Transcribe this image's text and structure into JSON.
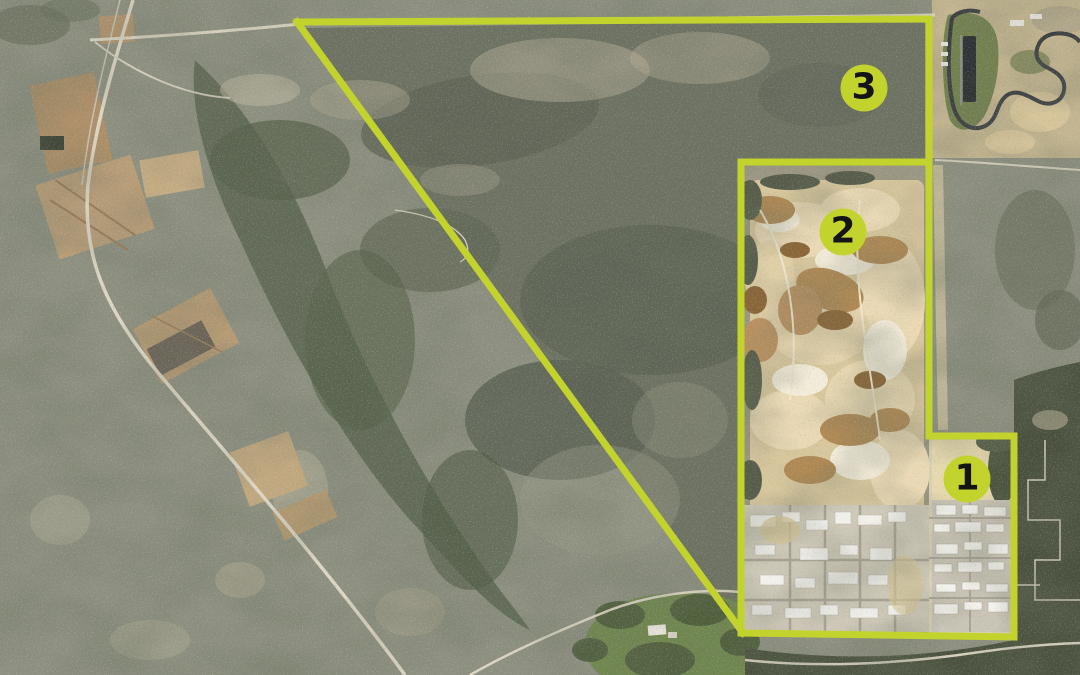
{
  "figure": {
    "accent_color": "#c3d32e",
    "marker_text_color": "#141414",
    "markers": [
      {
        "label": "1",
        "x": 967,
        "y": 479
      },
      {
        "label": "2",
        "x": 843,
        "y": 232
      },
      {
        "label": "3",
        "x": 864,
        "y": 88
      }
    ],
    "boundaries": [
      {
        "name": "site-3-top-and-right-edge",
        "points": [
          [
            297,
            22
          ],
          [
            929,
            19
          ],
          [
            929,
            162
          ]
        ]
      },
      {
        "name": "site-3-diagonal-edge",
        "points": [
          [
            297,
            22
          ],
          [
            743,
            633
          ]
        ]
      },
      {
        "name": "site-2-top-and-left-edge",
        "points": [
          [
            929,
            162
          ],
          [
            741,
            162
          ],
          [
            741,
            633
          ]
        ]
      },
      {
        "name": "site-2-right-edge",
        "points": [
          [
            929,
            162
          ],
          [
            929,
            436
          ]
        ]
      },
      {
        "name": "site-1-top-and-right-edge",
        "points": [
          [
            929,
            436
          ],
          [
            1014,
            436
          ],
          [
            1014,
            637
          ]
        ]
      },
      {
        "name": "south-shared-edge",
        "points": [
          [
            741,
            633
          ],
          [
            1014,
            637
          ]
        ]
      }
    ]
  }
}
